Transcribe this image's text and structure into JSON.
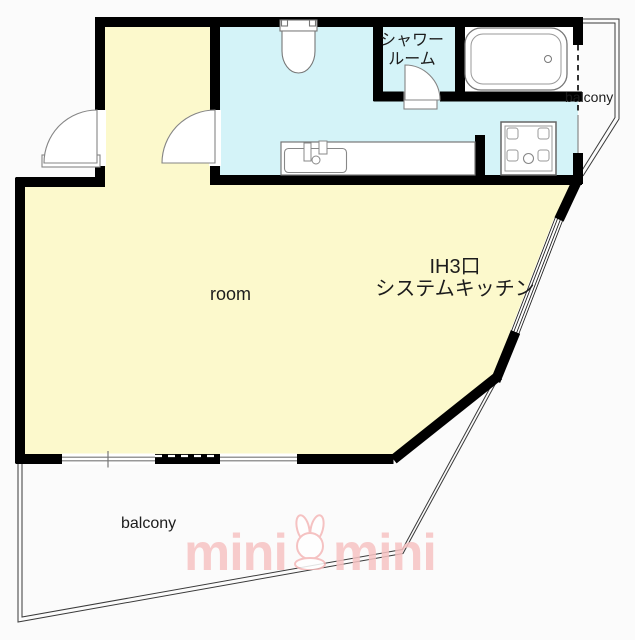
{
  "floorplan": {
    "labels": {
      "room": "room",
      "balcony_upper": "balcony",
      "balcony_lower": "balcony",
      "shower_room": [
        "シャワー",
        "ルーム"
      ],
      "kitchen": [
        "IH3口",
        "システムキッチン"
      ]
    },
    "watermark": {
      "left": "mini",
      "right": "mini",
      "icon": "rabbit",
      "color": "#f7c3c3"
    },
    "colors": {
      "room": "#fcf9cc",
      "wet_area": "#d4f3f8",
      "bath_area": "#ffffff",
      "wall": "#000000"
    },
    "fixtures": [
      "entrance-door",
      "hall-door",
      "toilet",
      "shower-door",
      "bathtub",
      "washing-machine-pan",
      "kitchen-counter",
      "sink"
    ]
  }
}
